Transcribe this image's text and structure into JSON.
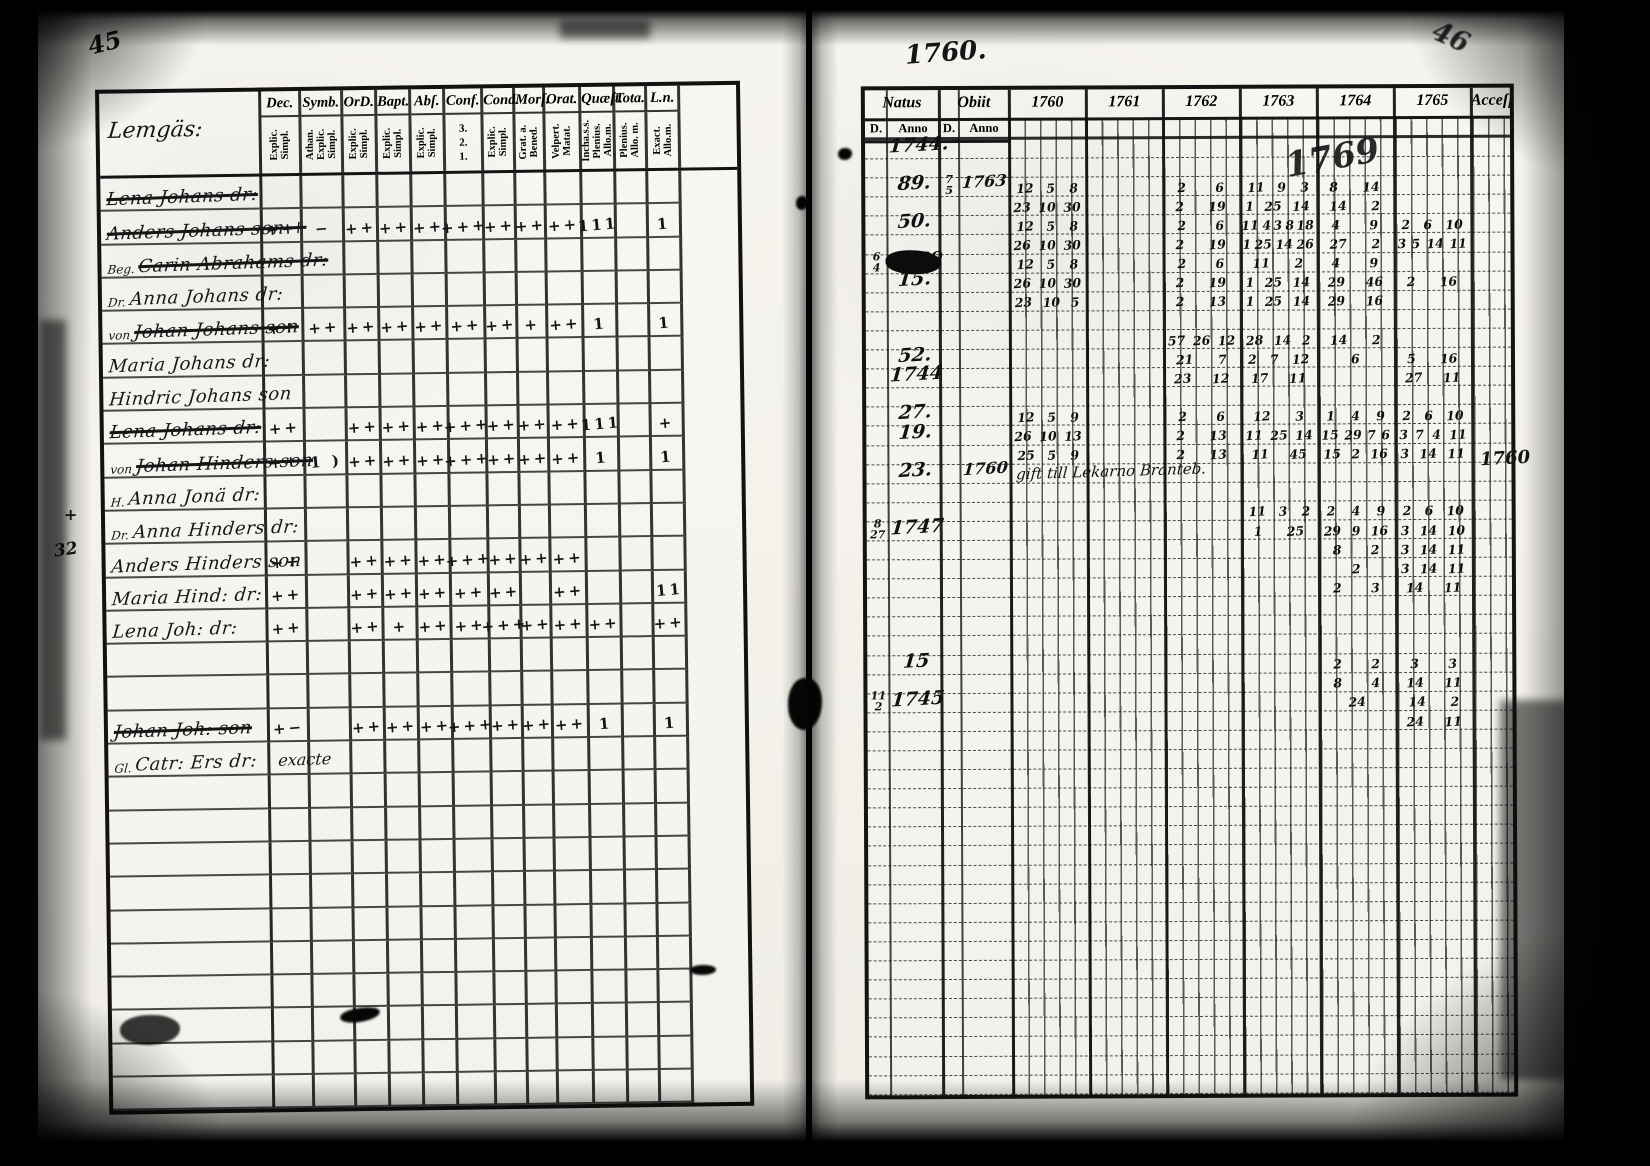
{
  "document": {
    "kind": "scanned parish register spread",
    "left_page_number": "45",
    "right_page_number": "46",
    "year_heading": "1760.",
    "big_year_scrawl": "1769",
    "right_margin_year": "1760",
    "left_margin_marks": [
      "+",
      "32"
    ]
  },
  "left_table": {
    "name_header": "Lemgäs:",
    "columns": [
      {
        "label": "Dec.",
        "sub": "Explic.\nSimpl."
      },
      {
        "label": "Symb.",
        "sub": "Athan.\nExplic.\nSimpl."
      },
      {
        "label": "OrD.",
        "sub": "Explic.\nSimpl."
      },
      {
        "label": "Bapt.",
        "sub": "Explic.\nSimpl."
      },
      {
        "label": "Abſ.",
        "sub": "Explic.\nSimpl."
      },
      {
        "label": "Conf.",
        "sub": "3.\n2.\n1.",
        "stack": true
      },
      {
        "label": "Cond.",
        "sub": "Explic.\nSimpl."
      },
      {
        "label": "Morſ.",
        "sub": "Grat. a.\nBened."
      },
      {
        "label": "Orat.",
        "sub": "Velpert.\nMatat."
      },
      {
        "label": "Quæſt.",
        "sub": "Incha.s.s.\nPlenius.\nAllo.m."
      },
      {
        "label": "Tota.",
        "sub": "Plenius.\nAllo. m."
      },
      {
        "label": "L.n.",
        "sub": "Exact.\nAllo.m."
      }
    ],
    "rows": [
      {
        "name": "Lena Johans dr:",
        "struck": true,
        "marks": [
          "",
          "",
          "",
          "",
          "",
          "",
          "",
          "",
          "",
          "",
          "",
          ""
        ]
      },
      {
        "name": "Anders Johans son +",
        "struck": true,
        "marks": [
          "++",
          "−",
          "++",
          "++",
          "++",
          "+++",
          "++",
          "++",
          "++",
          "111",
          "",
          "1"
        ]
      },
      {
        "name": "Carin Abrahams dr:",
        "prefix": "Beg.",
        "struck": true,
        "marks": [
          "",
          "",
          "",
          "",
          "",
          "",
          "",
          "",
          "",
          "",
          "",
          ""
        ]
      },
      {
        "name": "Anna Johans dr:",
        "prefix": "Dr.",
        "marks": [
          "",
          "",
          "",
          "",
          "",
          "",
          "",
          "",
          "",
          "",
          "",
          ""
        ]
      },
      {
        "name": "Johan Johans son",
        "prefix": "von",
        "struck": true,
        "marks": [
          "++",
          "++",
          "++",
          "++",
          "++",
          "++",
          "++",
          "+",
          "++",
          "1",
          "",
          "1"
        ]
      },
      {
        "name": "Maria Johans dr:",
        "marks": [
          "",
          "",
          "",
          "",
          "",
          "",
          "",
          "",
          "",
          "",
          "",
          ""
        ]
      },
      {
        "name": "Hindric Johans son",
        "marks": [
          "",
          "",
          "",
          "",
          "",
          "",
          "",
          "",
          "",
          "",
          "",
          ""
        ]
      },
      {
        "name": "Lena Johans dr:",
        "struck": true,
        "marks": [
          "++",
          "",
          "++",
          "++",
          "++",
          "+++",
          "++",
          "++",
          "++",
          "111",
          "",
          "+"
        ]
      },
      {
        "name": "Johan Hinders son",
        "prefix": "von",
        "struck": true,
        "marks": [
          "++",
          "1 )",
          "++",
          "++",
          "++",
          "+++",
          "++",
          "++",
          "++",
          "1",
          "",
          "1"
        ]
      },
      {
        "name": "Anna Jonä dr:",
        "prefix": "H.",
        "marks": [
          "",
          "",
          "",
          "",
          "",
          "",
          "",
          "",
          "",
          "",
          "",
          ""
        ]
      },
      {
        "name": "Anna Hinders dr:",
        "prefix": "Dr.",
        "marks": [
          "",
          "",
          "",
          "",
          "",
          "",
          "",
          "",
          "",
          "",
          "",
          ""
        ]
      },
      {
        "name": "Anders Hinders son",
        "marks": [
          "++",
          "",
          "++",
          "++",
          "++",
          "+++",
          "++",
          "++",
          "++",
          "",
          "",
          ""
        ]
      },
      {
        "name": "Maria Hind: dr:",
        "marks": [
          "++",
          "",
          "++",
          "++",
          "++",
          "++",
          "++",
          "",
          "++",
          "",
          "",
          "11"
        ]
      },
      {
        "name": "Lena Joh: dr:",
        "marks": [
          "++",
          "",
          "++",
          "+",
          "++",
          "++",
          "+++",
          "++",
          "++",
          "++",
          "",
          "++"
        ]
      },
      {
        "name": "",
        "marks": [
          "",
          "",
          "",
          "",
          "",
          "",
          "",
          "",
          "",
          "",
          "",
          ""
        ]
      },
      {
        "name": "",
        "marks": [
          "",
          "",
          "",
          "",
          "",
          "",
          "",
          "",
          "",
          "",
          "",
          ""
        ]
      },
      {
        "name": "Johan Joh: son",
        "struck": true,
        "marks": [
          "+−",
          "",
          "++",
          "++",
          "++",
          "+++",
          "++",
          "++",
          "++",
          "1",
          "",
          "1"
        ]
      },
      {
        "name": "Catr: Ers dr:",
        "prefix": "Gl.",
        "note": "exacte",
        "marks": [
          "",
          "",
          "",
          "",
          "",
          "",
          "",
          "",
          "",
          "",
          "",
          ""
        ]
      },
      {
        "name": "",
        "marks": [
          "",
          "",
          "",
          "",
          "",
          "",
          "",
          "",
          "",
          "",
          "",
          ""
        ]
      },
      {
        "name": "",
        "marks": [
          "",
          "",
          "",
          "",
          "",
          "",
          "",
          "",
          "",
          "",
          "",
          ""
        ]
      },
      {
        "name": "",
        "marks": [
          "",
          "",
          "",
          "",
          "",
          "",
          "",
          "",
          "",
          "",
          "",
          ""
        ]
      },
      {
        "name": "",
        "marks": [
          "",
          "",
          "",
          "",
          "",
          "",
          "",
          "",
          "",
          "",
          "",
          ""
        ]
      },
      {
        "name": "",
        "marks": [
          "",
          "",
          "",
          "",
          "",
          "",
          "",
          "",
          "",
          "",
          "",
          ""
        ]
      },
      {
        "name": "",
        "marks": [
          "",
          "",
          "",
          "",
          "",
          "",
          "",
          "",
          "",
          "",
          "",
          ""
        ]
      },
      {
        "name": "",
        "marks": [
          "",
          "",
          "",
          "",
          "",
          "",
          "",
          "",
          "",
          "",
          "",
          ""
        ]
      },
      {
        "name": "",
        "marks": [
          "",
          "",
          "",
          "",
          "",
          "",
          "",
          "",
          "",
          "",
          "",
          ""
        ]
      },
      {
        "name": "",
        "marks": [
          "",
          "",
          "",
          "",
          "",
          "",
          "",
          "",
          "",
          "",
          "",
          ""
        ]
      },
      {
        "name": "",
        "marks": [
          "",
          "",
          "",
          "",
          "",
          "",
          "",
          "",
          "",
          "",
          "",
          ""
        ]
      }
    ]
  },
  "right_table": {
    "natus_label": "Natus",
    "obiit_label": "Obiit",
    "d_label": "D.",
    "anno_label": "Anno",
    "years": [
      "1760",
      "1761",
      "1762",
      "1763",
      "1764",
      "1765"
    ],
    "edge_label": "Acceſſ.",
    "entries": [
      {
        "row": 0,
        "na": "1744."
      },
      {
        "row": 2,
        "na": "89.",
        "od": "7/5",
        "oa": "1763",
        "years": [
          "12 5 8",
          "",
          "2 6",
          "11 9 3",
          "8 14",
          ""
        ]
      },
      {
        "row": 3,
        "years": [
          "23 10 30",
          "",
          "2 19",
          "1 25 14",
          "14 2",
          ""
        ]
      },
      {
        "row": 4,
        "na": "50.",
        "years": [
          "12 5 8",
          "",
          "2 6",
          "11 4 3 8 18",
          "4 9",
          "2 6 10"
        ]
      },
      {
        "row": 5,
        "years": [
          "26 10 30",
          "",
          "2 19",
          "1 25 14 26",
          "27 2",
          "3 5 14 11"
        ]
      },
      {
        "row": 6,
        "nd": "6/4",
        "na": "1760",
        "blot": true,
        "years": [
          "12 5 8",
          "",
          "2 6",
          "11 2",
          "4 9",
          ""
        ]
      },
      {
        "row": 7,
        "na": "15.",
        "years": [
          "26 10 30",
          "",
          "2 19",
          "1 25 14",
          "29 46",
          "2 16"
        ]
      },
      {
        "row": 8,
        "years": [
          "23 10 5",
          "",
          "2 13",
          "1 25 14",
          "29 16",
          ""
        ]
      },
      {
        "row": 10,
        "years": [
          "",
          "",
          "57 26 12",
          "28 14 2",
          "14 2",
          ""
        ]
      },
      {
        "row": 11,
        "na": "52.",
        "years": [
          "",
          "",
          "21 7",
          "2 7 12",
          "6",
          "5 16"
        ]
      },
      {
        "row": 12,
        "na": "1744",
        "years": [
          "",
          "",
          "23 12",
          "17 11",
          "",
          "27 11"
        ]
      },
      {
        "row": 14,
        "na": "27.",
        "years": [
          "12 5 9",
          "",
          "2 6",
          "12 3",
          "1 4 9",
          "2 6 10"
        ]
      },
      {
        "row": 15,
        "na": "19.",
        "years": [
          "26 10 13",
          "",
          "2 13",
          "11 25 14",
          "15 29 7 6",
          "3 7 4 11"
        ]
      },
      {
        "row": 16,
        "years": [
          "25 5 9",
          "",
          "2 13",
          "11 45",
          "15 2 16",
          "3 14 11"
        ]
      },
      {
        "row": 17,
        "na": "23.",
        "oa": "1760",
        "note": "gift till Lekarno Branteb."
      },
      {
        "row": 19,
        "years": [
          "",
          "",
          "",
          "11 3 2",
          "2 4 9",
          "2 6 10"
        ]
      },
      {
        "row": 20,
        "nd": "8/27",
        "na": "1747",
        "years": [
          "",
          "",
          "",
          "1 25",
          "29 9 16",
          "3 14 10"
        ]
      },
      {
        "row": 21,
        "years": [
          "",
          "",
          "",
          "",
          "8 2",
          "3 14 11"
        ]
      },
      {
        "row": 22,
        "years": [
          "",
          "",
          "",
          "",
          "2",
          "3 14 11"
        ]
      },
      {
        "row": 23,
        "years": [
          "",
          "",
          "",
          "",
          "2 3",
          "14 11"
        ]
      },
      {
        "row": 27,
        "na": "15",
        "years": [
          "",
          "",
          "",
          "",
          "2 2",
          "3 3"
        ]
      },
      {
        "row": 28,
        "years": [
          "",
          "",
          "",
          "",
          "8 4",
          "14 11"
        ]
      },
      {
        "row": 29,
        "nd": "11/2",
        "na": "1745",
        "years": [
          "",
          "",
          "",
          "",
          "24",
          "14 2"
        ]
      },
      {
        "row": 30,
        "years": [
          "",
          "",
          "",
          "",
          "",
          "24 11"
        ]
      }
    ]
  }
}
